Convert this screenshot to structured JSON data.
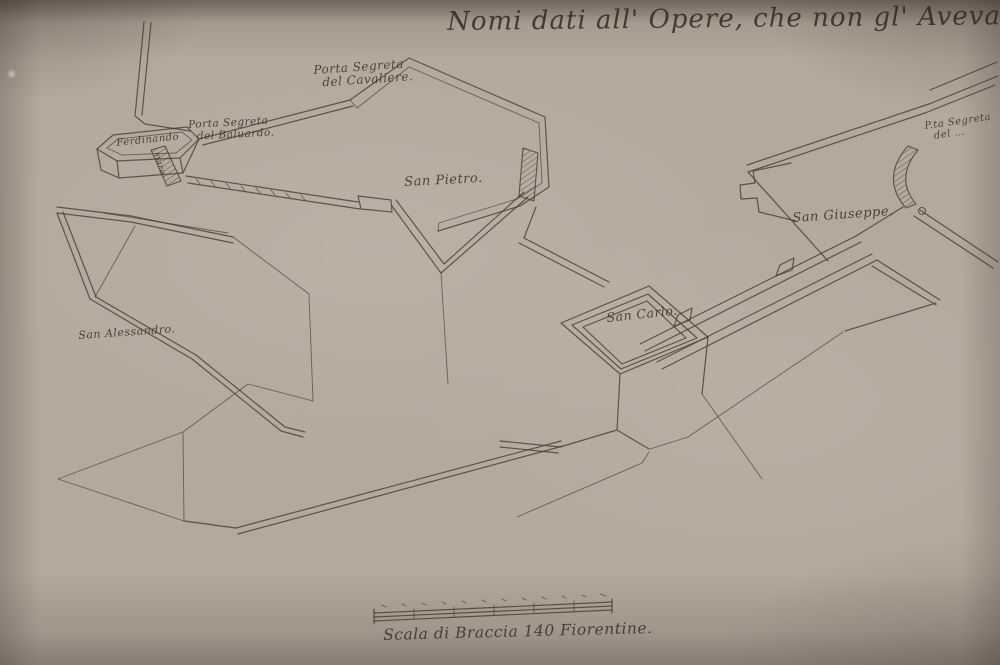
{
  "artifact": {
    "kind": "hand-drawn fortification plan, sepia ink on aged paper (photograph)",
    "title": {
      "text": "Nomi dati all' Opere, che non gl' Avevano.",
      "number": "34"
    }
  },
  "map_labels": {
    "porta_segreta_cavaliere": {
      "line1": "Porta Segreta",
      "line2": "del Cavaliere."
    },
    "porta_segreta_baluardo": {
      "line1": "Porta Segreta",
      "line2": "del Baluardo."
    },
    "bastion_cartouche": "Ferdinando",
    "muro": "muro",
    "san_pietro": "San Pietro.",
    "san_giuseppe": "San Giuseppe.",
    "san_carlo": "San Carlo.",
    "san_alessandro": "San Alessandro.",
    "porta_segreta_destra": {
      "line1": "P.ta Segreta",
      "line2": "del …"
    }
  },
  "scale_bar": {
    "label": "Scala di Braccia 140 Fiorentine.",
    "tick_count": 12
  },
  "colors": {
    "paper": "#b5a89d",
    "paper-light": "#c2b5aa",
    "ink": "#4a3f35",
    "ink-text": "#3e352c"
  }
}
